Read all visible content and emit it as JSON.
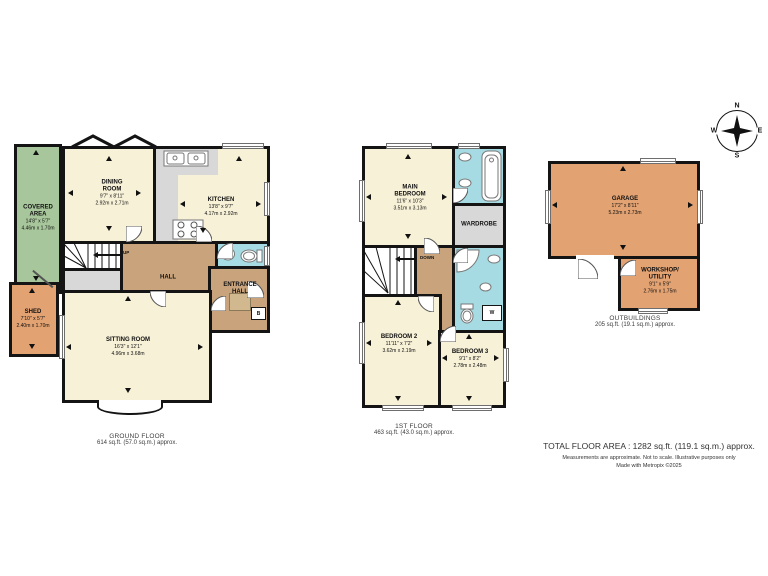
{
  "meta": {
    "kind": "estate-agent floor plan"
  },
  "colors": {
    "room_cream": "#f7f1d7",
    "hall_tan": "#c8a37c",
    "bathroom_blue": "#a6dbe3",
    "utility_gray": "#d8d8d8",
    "covered_green": "#a7c69b",
    "outbuilding_orange": "#e2a272",
    "wall_black": "#141414"
  },
  "compass": {
    "n": "N",
    "e": "E",
    "s": "S",
    "w": "W"
  },
  "ground_floor": {
    "title": "GROUND FLOOR",
    "area": "614 sq.ft. (57.0 sq.m.) approx.",
    "stairs_label": "UP",
    "boiler_label": "B",
    "rooms": {
      "covered_area": {
        "name": "COVERED AREA",
        "imperial": "14'8\" x 5'7\"",
        "metric": "4.46m x 1.70m"
      },
      "shed": {
        "name": "SHED",
        "imperial": "7'10\" x 5'7\"",
        "metric": "2.40m x 1.70m"
      },
      "dining_room": {
        "name": "DINING ROOM",
        "imperial": "9'7\" x 8'11\"",
        "metric": "2.92m x 2.71m"
      },
      "kitchen": {
        "name": "KITCHEN",
        "imperial": "13'8\" x 9'7\"",
        "metric": "4.17m x 2.92m"
      },
      "hall": {
        "name": "HALL"
      },
      "entrance_hall": {
        "name": "ENTRANCE HALL"
      },
      "sitting_room": {
        "name": "SITTING ROOM",
        "imperial": "16'3\" x 12'1\"",
        "metric": "4.96m x 3.68m"
      }
    }
  },
  "first_floor": {
    "title": "1ST FLOOR",
    "area": "463 sq.ft. (43.0 sq.m.) approx.",
    "stairs_label": "DOWN",
    "cupboard_label": "W",
    "rooms": {
      "main_bedroom": {
        "name": "MAIN BEDROOM",
        "imperial": "11'6\" x 10'3\"",
        "metric": "3.51m x 3.13m"
      },
      "wardrobe": {
        "name": "WARDROBE"
      },
      "bedroom_2": {
        "name": "BEDROOM 2",
        "imperial": "11'11\" x 7'2\"",
        "metric": "3.62m x 2.19m"
      },
      "bedroom_3": {
        "name": "BEDROOM 3",
        "imperial": "9'1\" x 8'2\"",
        "metric": "2.78m x 2.48m"
      }
    }
  },
  "outbuildings": {
    "title": "OUTBUILDINGS",
    "area": "205 sq.ft. (19.1 sq.m.) approx.",
    "rooms": {
      "garage": {
        "name": "GARAGE",
        "imperial": "17'2\" x 8'11\"",
        "metric": "5.23m x 2.73m"
      },
      "workshop_utility": {
        "name": "WORKSHOP/ UTILITY",
        "imperial": "9'1\" x 5'9\"",
        "metric": "2.76m x 1.75m"
      }
    }
  },
  "footer": {
    "total_area": "TOTAL FLOOR AREA : 1282 sq.ft. (119.1 sq.m.) approx.",
    "disclaimer_line1": "Measurements are approximate.  Not to scale.  Illustrative purposes only",
    "disclaimer_line2": "Made with Metropix ©2025"
  }
}
